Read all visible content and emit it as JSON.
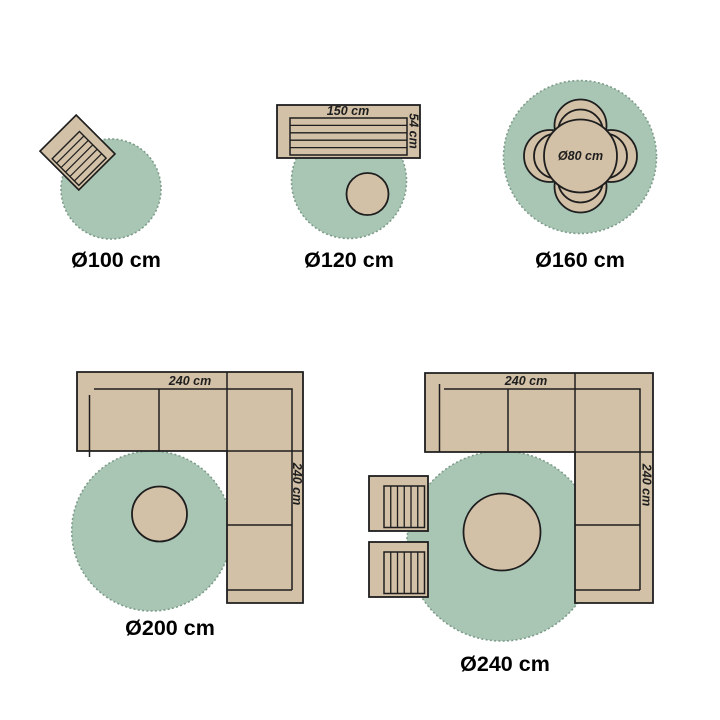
{
  "colors": {
    "background": "#ffffff",
    "rug_fill": "#a9c6b4",
    "rug_edge": "#7d9c8a",
    "furniture_fill": "#d3c1a7",
    "outline": "#1e1e1e",
    "label_text": "#000000"
  },
  "figures": [
    {
      "name": "round-rug-100",
      "size_label": "Ø100 cm",
      "furniture": [
        "tilted-slatted-garden-chair"
      ]
    },
    {
      "name": "round-rug-120",
      "size_label": "Ø120 cm",
      "furniture": [
        "slatted-garden-bench",
        "round-side-table"
      ],
      "bench_width": "150 cm",
      "bench_depth": "54 cm"
    },
    {
      "name": "round-rug-160",
      "size_label": "Ø160 cm",
      "furniture": [
        "round-dining-table",
        "four-dining-chairs"
      ],
      "table_diameter": "Ø80 cm"
    },
    {
      "name": "round-rug-200",
      "size_label": "Ø200 cm",
      "furniture": [
        "corner-sofa",
        "round-coffee-table"
      ],
      "sofa_width": "240 cm",
      "sofa_depth": "240 cm"
    },
    {
      "name": "round-rug-240",
      "size_label": "Ø240 cm",
      "furniture": [
        "corner-sofa",
        "round-coffee-table",
        "two-slatted-garden-chairs"
      ],
      "sofa_width": "240 cm",
      "sofa_depth": "240 cm"
    }
  ]
}
